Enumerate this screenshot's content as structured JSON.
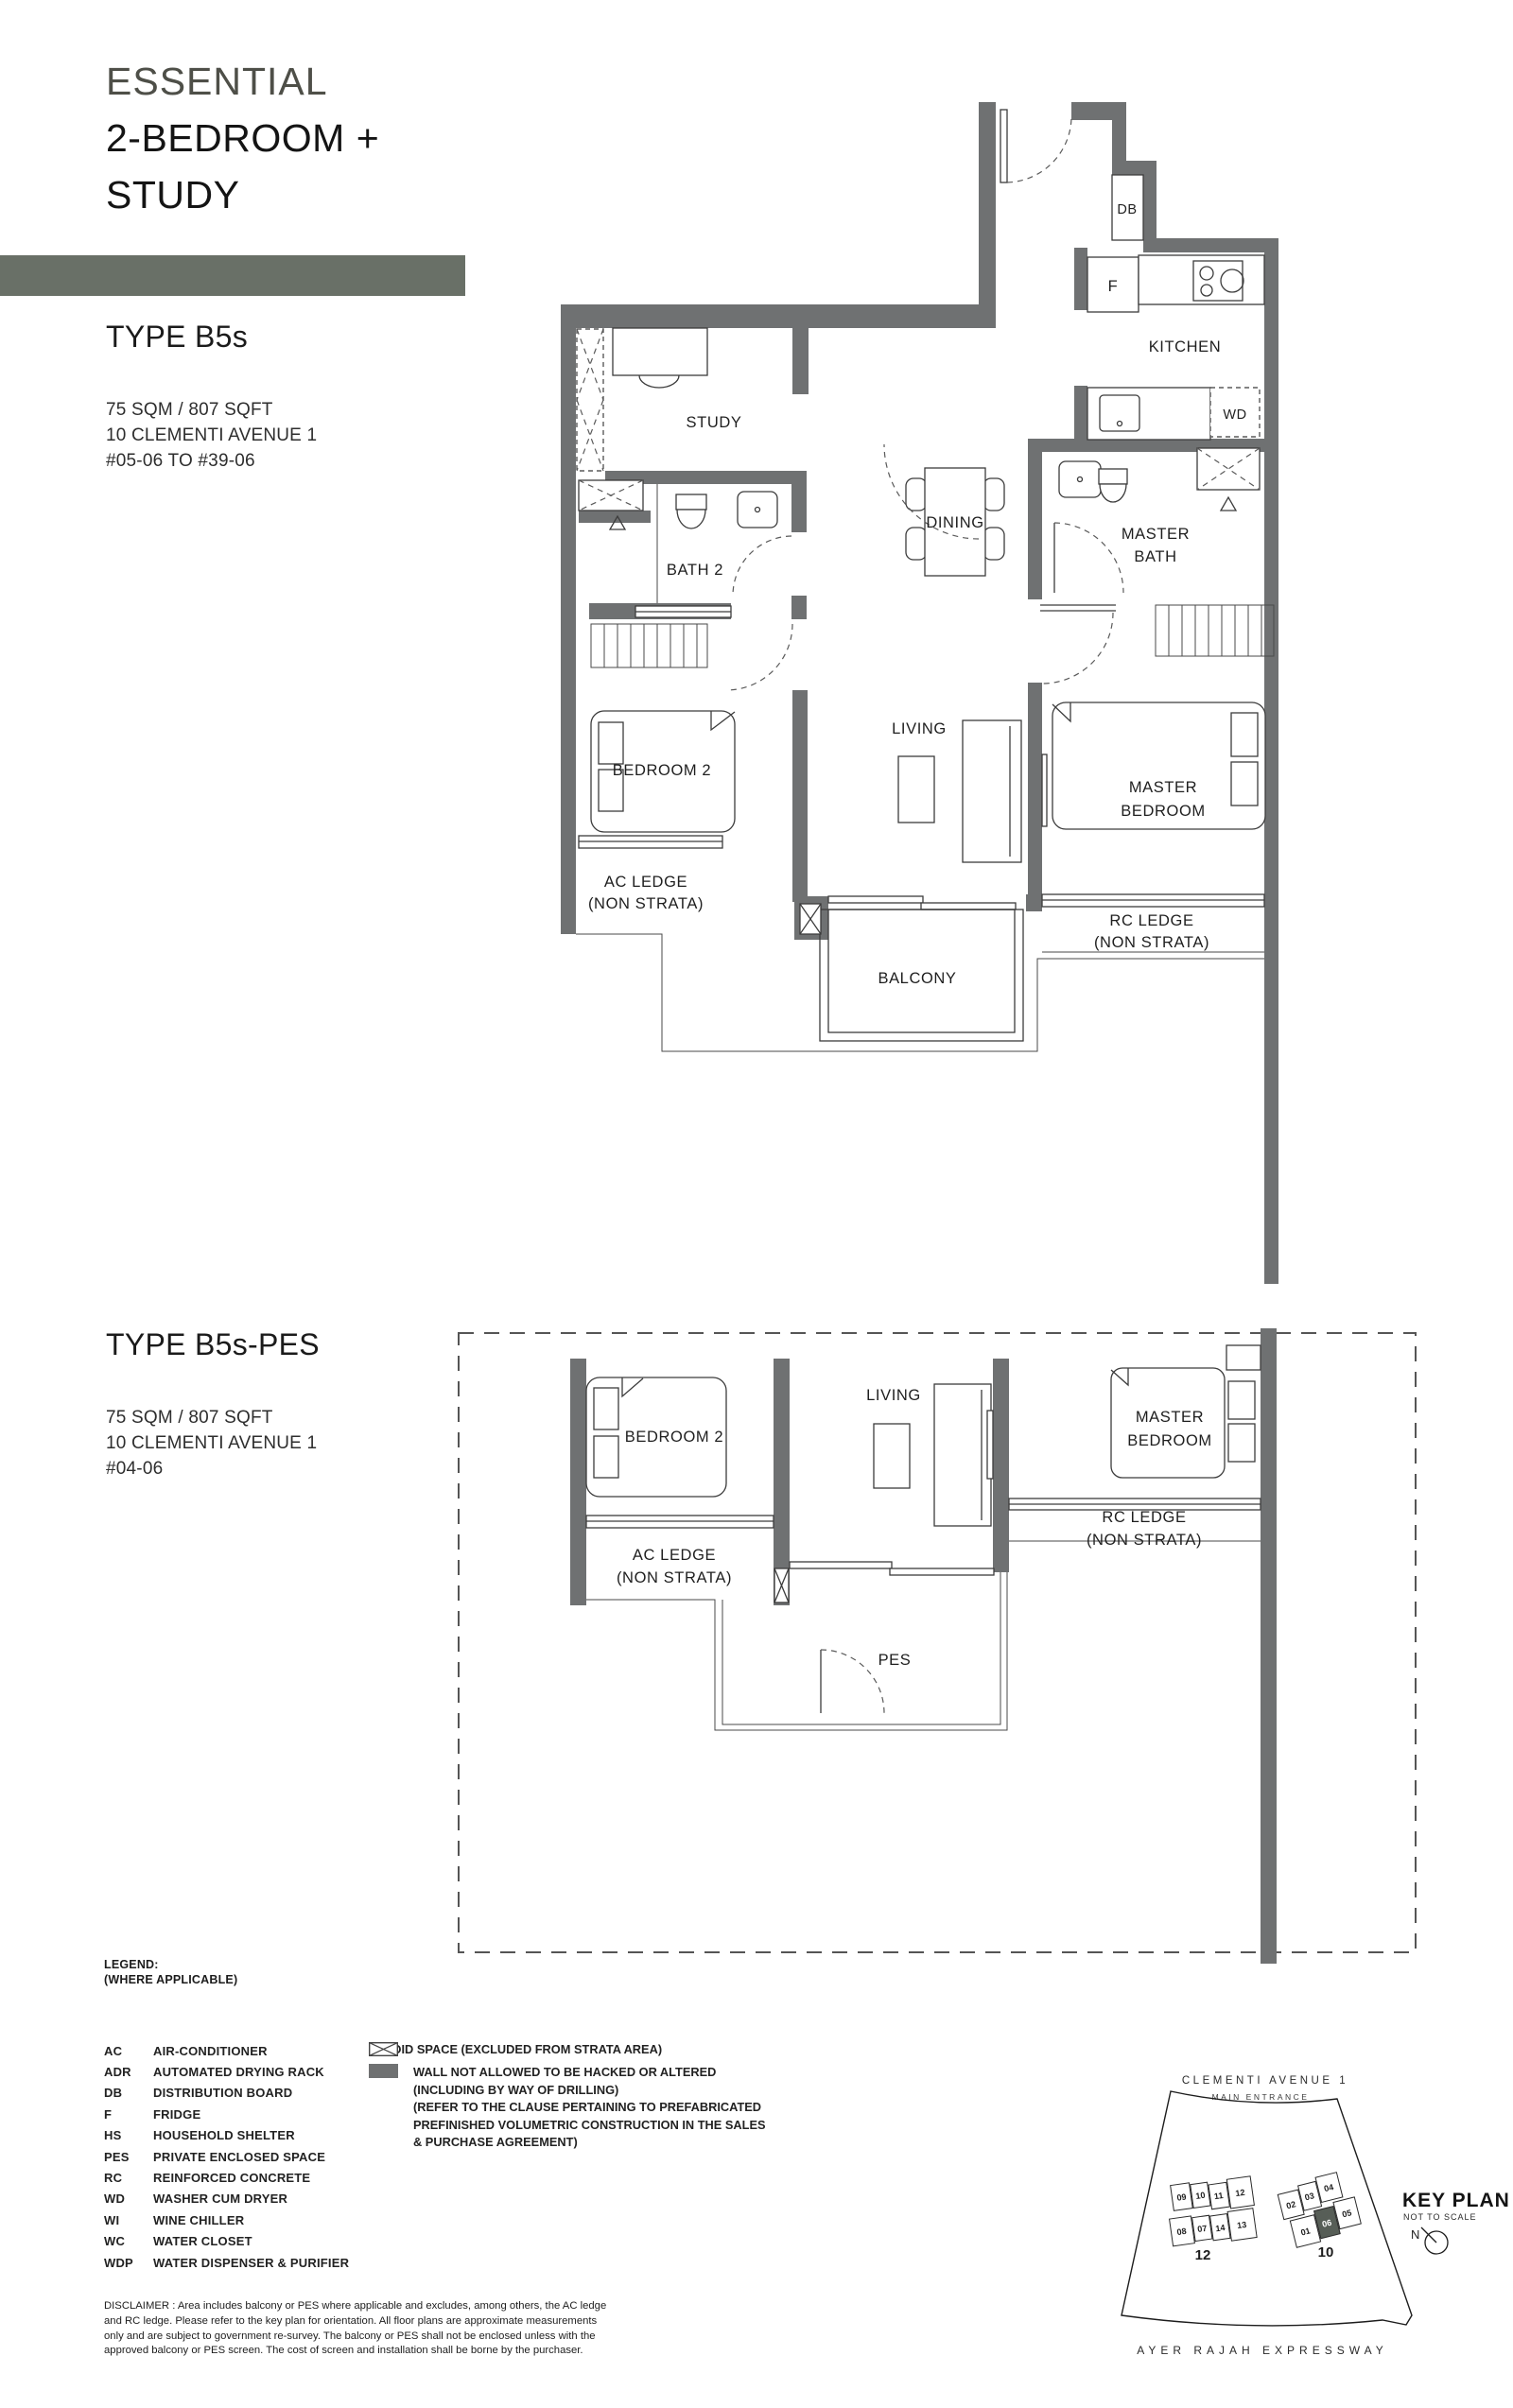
{
  "header": {
    "eyebrow": "ESSENTIAL",
    "title_l1": "2-BEDROOM +",
    "title_l2": "STUDY"
  },
  "colors": {
    "accent_bar": "#697067",
    "wall": "#6F7172",
    "unit_highlight": "#575E57",
    "eyebrow_text": "#4E4F48"
  },
  "type1": {
    "name": "TYPE B5s",
    "area": "75 SQM / 807 SQFT",
    "address": "10 CLEMENTI AVENUE 1",
    "stack": "#05-06 TO #39-06"
  },
  "type2": {
    "name": "TYPE B5s-PES",
    "area": "75 SQM / 807 SQFT",
    "address": "10 CLEMENTI AVENUE 1",
    "stack": "#04-06"
  },
  "plan1": {
    "study": "STUDY",
    "kitchen": "KITCHEN",
    "dining": "DINING",
    "bath2": "BATH 2",
    "master_bath_1": "MASTER",
    "master_bath_2": "BATH",
    "bedroom2": "BEDROOM 2",
    "living": "LIVING",
    "master_bed_1": "MASTER",
    "master_bed_2": "BEDROOM",
    "balcony": "BALCONY",
    "ac_ledge_1": "AC LEDGE",
    "ac_ledge_2": "(NON STRATA)",
    "rc_ledge_1": "RC LEDGE",
    "rc_ledge_2": "(NON STRATA)",
    "db": "DB",
    "fridge": "F",
    "wd": "WD"
  },
  "plan2": {
    "bedroom2": "BEDROOM 2",
    "living": "LIVING",
    "master_bed_1": "MASTER",
    "master_bed_2": "BEDROOM",
    "ac_ledge_1": "AC LEDGE",
    "ac_ledge_2": "(NON STRATA)",
    "rc_ledge_1": "RC LEDGE",
    "rc_ledge_2": "(NON STRATA)",
    "pes": "PES"
  },
  "legend": {
    "title": "LEGEND:",
    "subtitle": "(WHERE APPLICABLE)",
    "items": [
      {
        "abbr": "AC",
        "desc": "AIR-CONDITIONER"
      },
      {
        "abbr": "ADR",
        "desc": "AUTOMATED DRYING RACK"
      },
      {
        "abbr": "DB",
        "desc": "DISTRIBUTION BOARD"
      },
      {
        "abbr": "F",
        "desc": "FRIDGE"
      },
      {
        "abbr": "HS",
        "desc": "HOUSEHOLD SHELTER"
      },
      {
        "abbr": "PES",
        "desc": "PRIVATE ENCLOSED SPACE"
      },
      {
        "abbr": "RC",
        "desc": "REINFORCED CONCRETE"
      },
      {
        "abbr": "WD",
        "desc": "WASHER CUM DRYER"
      },
      {
        "abbr": "WI",
        "desc": "WINE CHILLER"
      },
      {
        "abbr": "WC",
        "desc": "WATER CLOSET"
      },
      {
        "abbr": "WDP",
        "desc": "WATER DISPENSER & PURIFIER"
      }
    ],
    "void_text": "VOID SPACE (EXCLUDED FROM STRATA AREA)",
    "wall_text": {
      "l1": "WALL NOT ALLOWED TO BE HACKED OR ALTERED",
      "l2": "(INCLUDING BY WAY OF DRILLING)",
      "l3": "(REFER TO THE CLAUSE PERTAINING TO PREFABRICATED",
      "l4": "PREFINISHED VOLUMETRIC CONSTRUCTION IN THE SALES",
      "l5": "& PURCHASE AGREEMENT)"
    }
  },
  "disclaimer": {
    "l1": "DISCLAIMER : Area includes balcony or PES where applicable and excludes, among others, the AC ledge",
    "l2": "and RC ledge. Please refer to the key plan for orientation. All floor plans are approximate measurements",
    "l3": "only and are subject to government re-survey. The balcony or PES shall not be enclosed unless with the",
    "l4": "approved balcony or PES screen. The cost of screen and installation shall be borne by the purchaser."
  },
  "keyplan": {
    "street": "CLEMENTI AVENUE 1",
    "main_entrance": "MAIN ENTRANCE",
    "expressway": "AYER RAJAH EXPRESSWAY",
    "title": "KEY PLAN",
    "not_to_scale": "NOT TO SCALE",
    "north": "N",
    "left_block": "12",
    "right_block": "10",
    "left_units": [
      "09",
      "10",
      "11",
      "12",
      "08",
      "07",
      "14",
      "13"
    ],
    "right_units": [
      "02",
      "03",
      "04",
      "01",
      "06",
      "05"
    ],
    "highlighted_unit": "06"
  }
}
